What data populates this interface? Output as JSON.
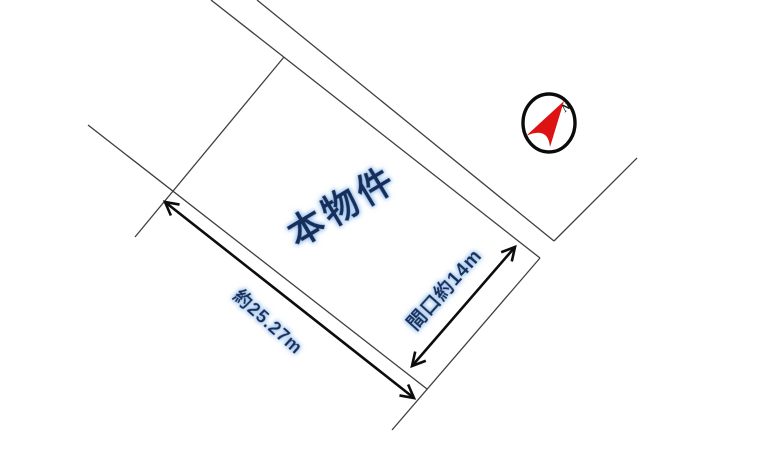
{
  "diagram": {
    "property_label": "本物件",
    "dimensions": {
      "side_length_label": "約25.27m",
      "frontage_label": "間口約14m"
    },
    "compass": {
      "north_label": "N"
    },
    "colors": {
      "background": "#ffffff",
      "boundary_line": "#3f3f3f",
      "dimension_arrow": "#0d0d0d",
      "label_text": "#142e5c",
      "label_glow": "#9cc2ec",
      "compass_red": "#dd1212",
      "compass_ring": "#0b0b0b"
    }
  }
}
